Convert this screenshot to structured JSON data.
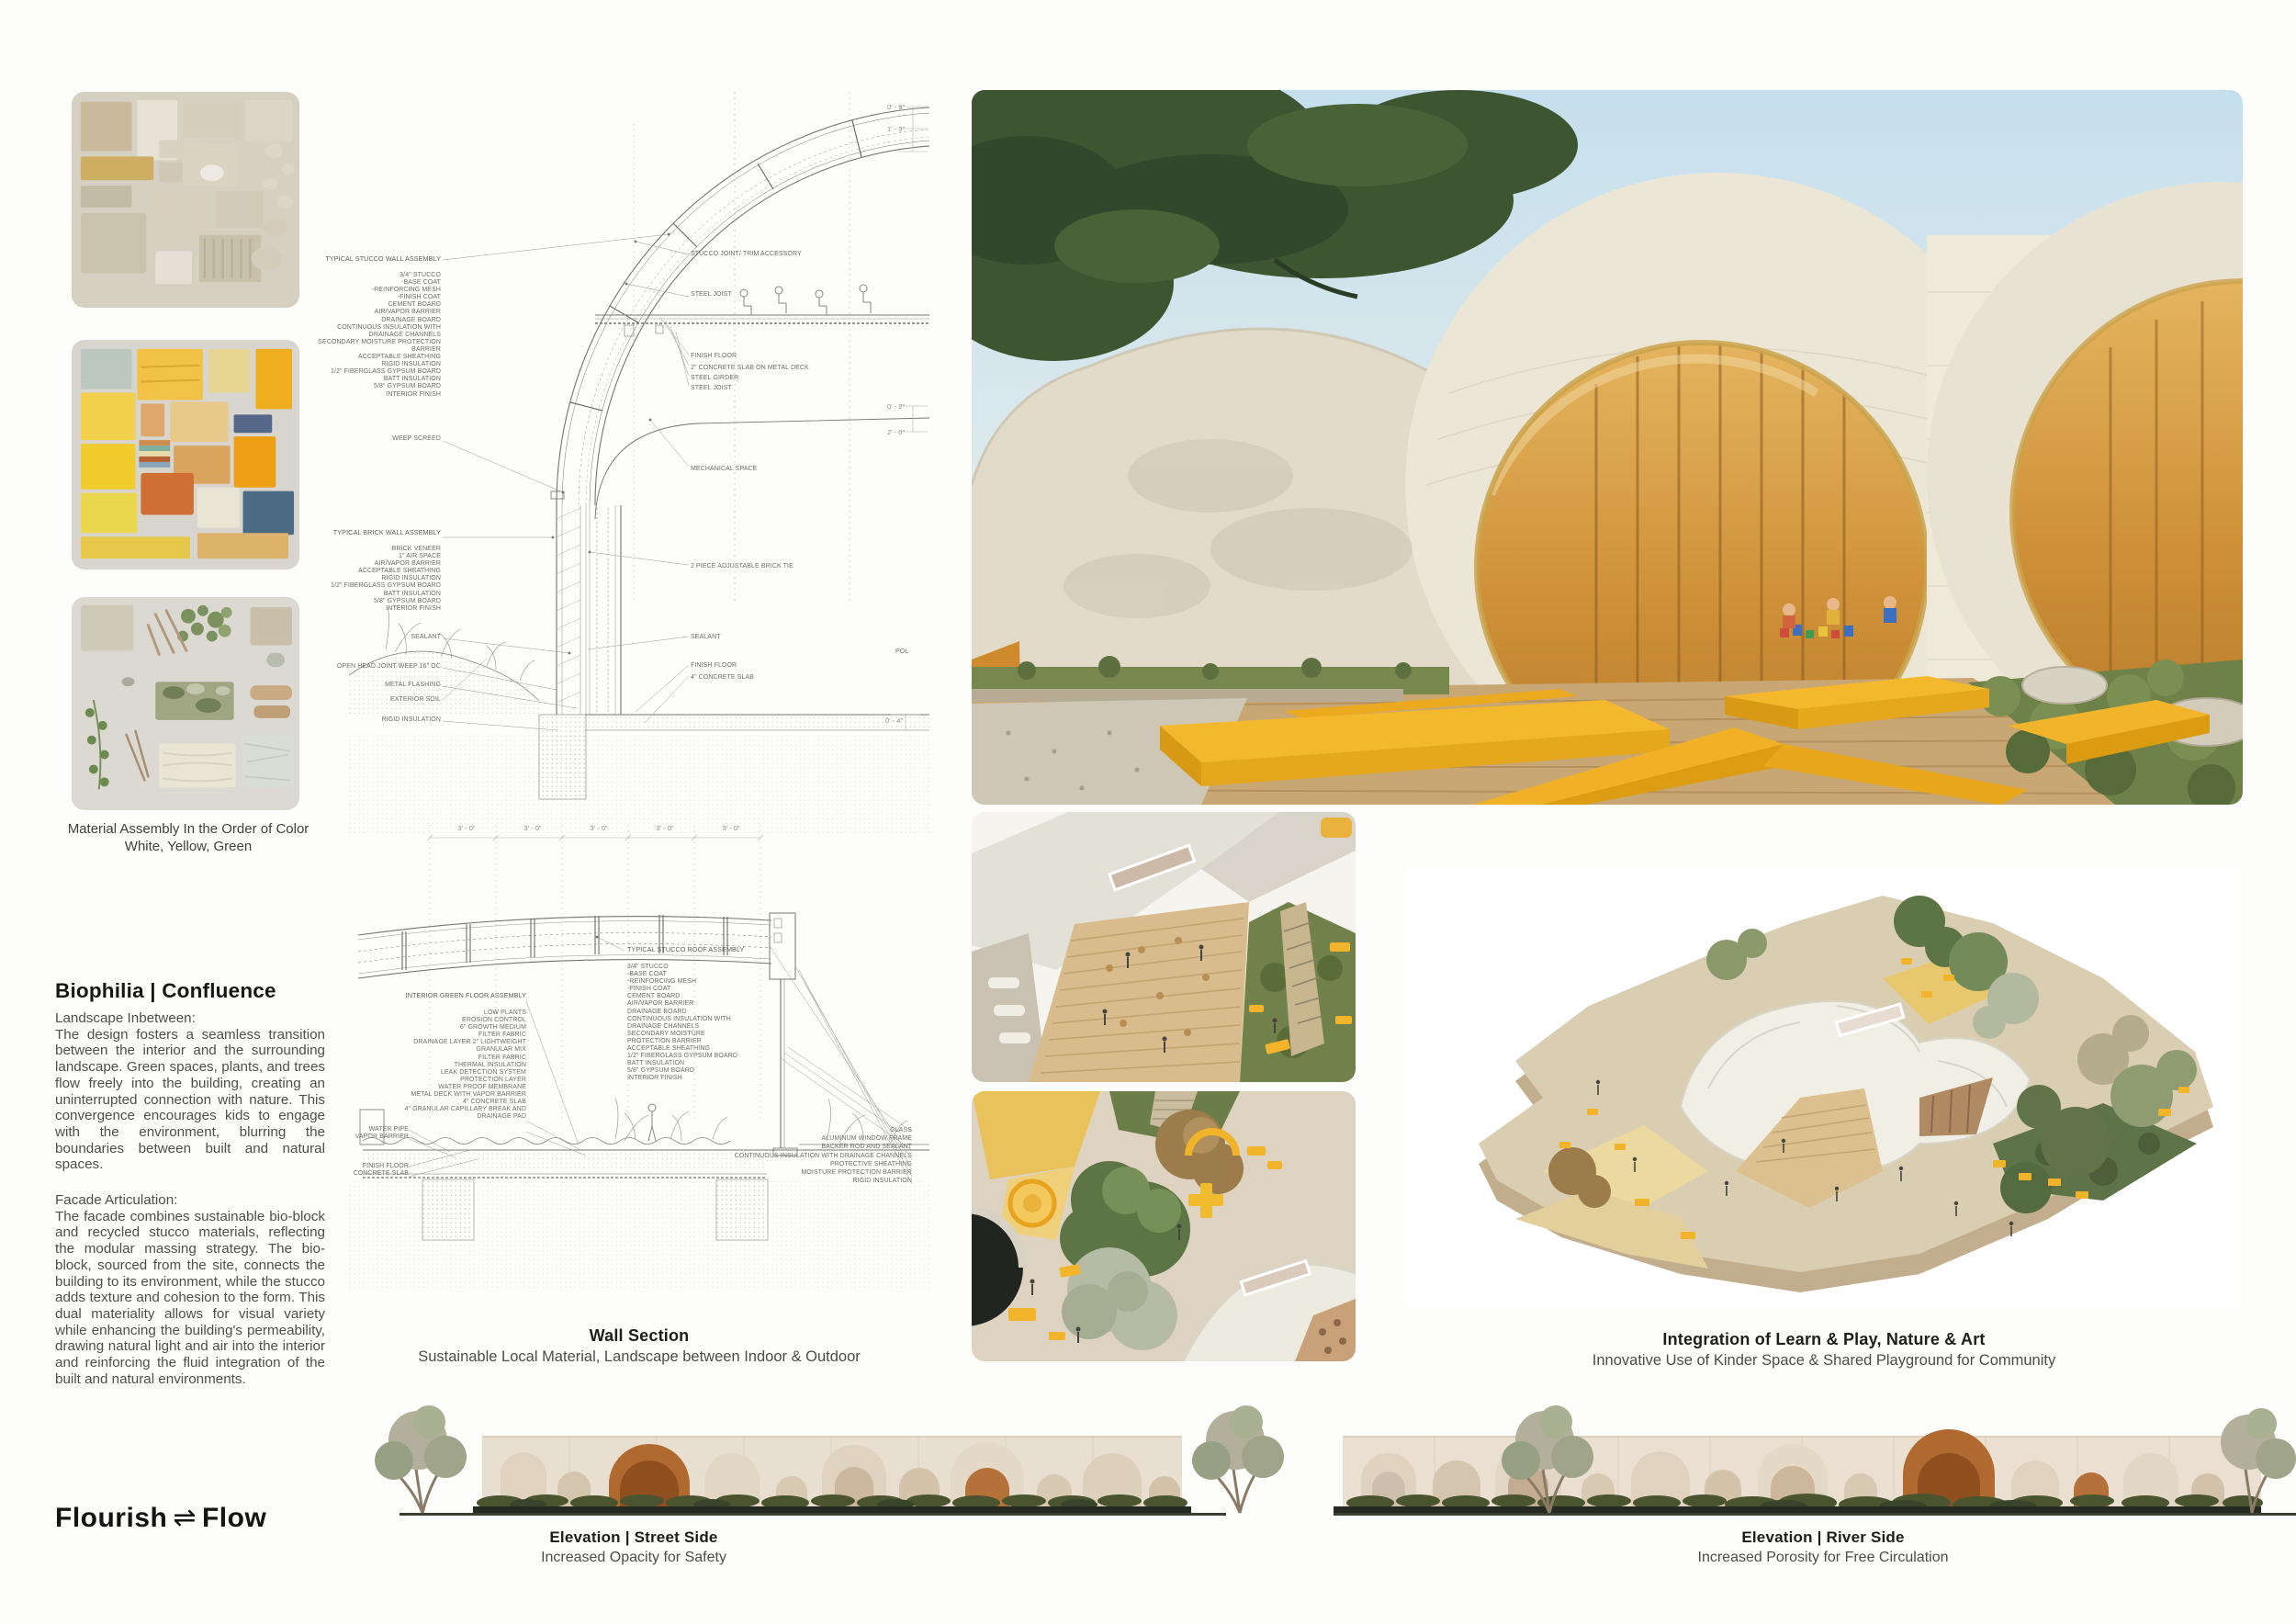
{
  "materials": {
    "caption_line1": "Material Assembly In the Order of Color",
    "caption_line2": "White, Yellow, Green"
  },
  "biophilia": {
    "heading": "Biophilia | Confluence",
    "para1_title": "Landscape Inbetween:",
    "para1": "The design fosters a seamless transition between the interior and the surrounding landscape. Green spaces, plants, and trees flow freely into the building, creating an uninterrupted connection with nature. This convergence encourages kids to engage with the environment, blurring the boundaries between built and natural spaces.",
    "para2_title": "Facade Articulation:",
    "para2": "The facade combines sustainable bio-block and recycled stucco materials, reflecting the modular massing strategy. The bio-block, sourced from the site, connects the building to its environment, while the stucco adds texture and cohesion to the form. This dual materiality allows for visual variety while enhancing the building's permeability, drawing natural light and air into the interior and reinforcing the fluid integration of the built and natural environments."
  },
  "logo": {
    "word1": "Flourish",
    "symbol": "⇌",
    "word2": "Flow"
  },
  "wall_section": {
    "caption_title": "Wall Section",
    "caption_sub": "Sustainable Local Material, Landscape between Indoor & Outdoor",
    "upper": {
      "stucco_title": "TYPICAL STUCCO WALL ASSEMBLY",
      "stucco_items": [
        "3/4\" STUCCO",
        "-BASE COAT",
        "-REINFORCING MESH",
        "-FINISH COAT",
        "CEMENT BOARD",
        "AIR/VAPOR BARRIER",
        "DRAINAGE BOARD",
        "CONTINUOUS INSULATION WITH",
        "DRAINAGE CHANNELS",
        "SECONDARY MOISTURE PROTECTION",
        "BARRIER",
        "ACCEPTABLE SHEATHING",
        "RIGID INSULATION",
        "1/2\" FIBERGLASS GYPSUM BOARD",
        "BATT INSULATION",
        "5/8\" GYPSUM BOARD",
        "INTERIOR FINISH"
      ],
      "weep": "WEEP SCREED",
      "brick_title": "TYPICAL BRICK WALL ASSEMBLY",
      "brick_items": [
        "BRICK VENEER",
        "1\" AIR SPACE",
        "AIR/VAPOR BARRIER",
        "ACCEPTABLE SHEATHING",
        "RIGID INSULATION",
        "1/2\" FIBERGLASS GYPSUM BOARD",
        "BATT INSULATION",
        "5/8\" GYPSUM BOARD",
        "INTERIOR FINISH"
      ],
      "sealant_l": "SEALANT",
      "open_head": "OPEN HEAD JOINT WEEP 16\" OC",
      "metal_flashing": "METAL FLASHING",
      "exterior_soil": "EXTERIOR SOIL",
      "rigid_ins": "RIGID INSULATION",
      "right": {
        "joint": "STUCCO JOINT/ TRIM ACCESSORY",
        "joist1": "STEEL JOIST",
        "finish1": "FINISH FLOOR",
        "slab2": "2\" CONCRETE SLAB ON METAL DECK",
        "girder": "STEEL GIRDER",
        "joist2": "STEEL JOIST",
        "mech": "MECHANICAL SPACE",
        "tie": "2 PIECE ADJUSTABLE BRICK TIE",
        "sealant": "SEALANT",
        "finish2": "FINISH FLOOR",
        "slab4": "4\" CONCRETE SLAB",
        "pol": "POL"
      },
      "dims": [
        "0' - 9\"",
        "1' - 3\"",
        "0' - 2\"",
        "2' - 0\"",
        "0' - 4\""
      ]
    },
    "lower": {
      "top_dims": [
        "3' - 0\"",
        "3' - 0\"",
        "3' - 0\"",
        "3' - 0\"",
        "3' - 0\""
      ],
      "green_title": "INTERIOR GREEN FLOOR ASSEMBLY",
      "green_items": [
        "LOW PLANTS",
        "EROSION CONTROL",
        "6\" GROWTH MEDIUM",
        "FILTER FABRIC",
        "DRAINAGE LAYER 2\" LIGHTWEIGHT",
        "GRANULAR MIX",
        "FILTER FABRIC",
        "THERMAL INSULATION",
        "LEAK DETECTION SYSTEM",
        "PROTECTION LAYER",
        "WATER PROOF MEMBRANE",
        "METAL DECK WITH VAPOR BARRIER",
        "4\" CONCRETE SLAB",
        "4\" GRANULAR CAPILLARY BREAK AND",
        "DRAINAGE PAD"
      ],
      "farleft_pair1": [
        "WATER PIPE",
        "VAPOR BARRIER"
      ],
      "farleft_pair2": [
        "FINISH FLOOR",
        "CONCRETE SLAB"
      ],
      "roof_title": "TYPICAL STUCCO ROOF ASSEMBLY",
      "roof_items": [
        "3/4\" STUCCO",
        "-BASE COAT",
        "-REINFORCING MESH",
        "-FINISH COAT",
        "CEMENT BOARD",
        "AIR/VAPOR BARRIER",
        "DRAINAGE BOARD",
        "CONTINUOUS INSULATION WITH",
        "DRAINAGE CHANNELS",
        "SECONDARY MOISTURE",
        "PROTECTION BARRIER",
        "ACCEPTABLE SHEATHING",
        "1/2\" FIBERGLASS GYPSUM BOARD",
        "BATT INSULATION",
        "5/8\" GYPSUM BOARD",
        "INTERIOR FINISH"
      ],
      "farright_items": [
        "GLASS",
        "ALUMINUM WINDOW FRAME",
        "BACKER ROD AND SEALANT",
        "CONTINUOUS INSULATION WITH DRAINAGE CHANNELS",
        "PROTECTIVE SHEATHING",
        "MOISTURE PROTECTION BARRIER",
        "RIGID INSULATION"
      ]
    }
  },
  "axon_caption": {
    "title": "Integration of Learn & Play, Nature & Art",
    "sub": "Innovative Use of Kinder Space & Shared Playground for Community"
  },
  "elevations": {
    "street": {
      "title": "Elevation | Street Side",
      "sub": "Increased Opacity for Safety"
    },
    "river": {
      "title": "Elevation | River Side",
      "sub": "Increased Porosity for Free Circulation"
    }
  },
  "colors": {
    "accent_yellow": "#F2B32C",
    "cream_shell": "#EAE4D4",
    "amber_glass": "#D79C3F",
    "moss_green": "#6F8348",
    "canopy_green": "#3E5431",
    "sky_blue": "#CFE4F0"
  }
}
